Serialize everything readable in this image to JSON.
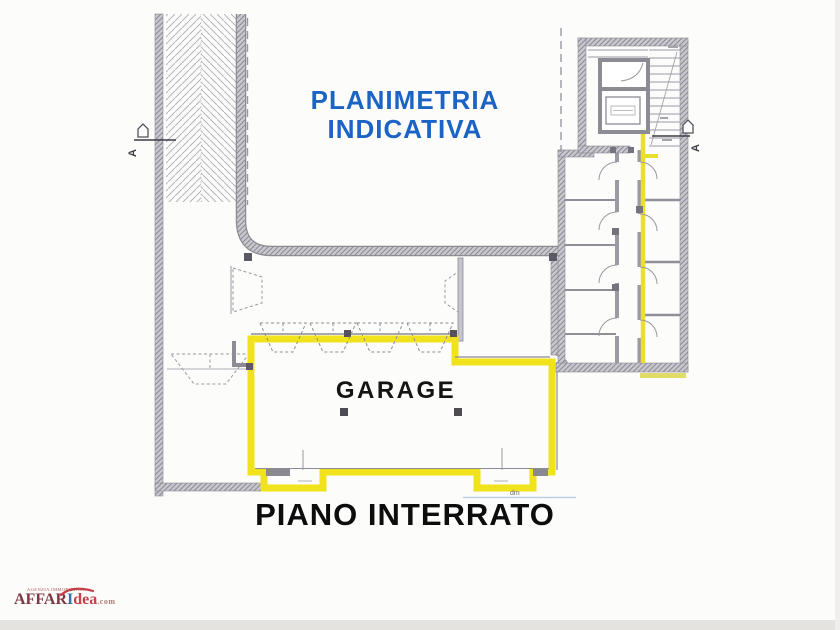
{
  "plan": {
    "title_line1": "PLANIMETRIA",
    "title_line2": "INDICATIVA",
    "garage_label": "GARAGE",
    "floor_label": "PIANO INTERRATO",
    "section_marker_left": "A",
    "section_marker_right": "A",
    "dim_mark": "dm"
  },
  "logo": {
    "tagline": "AGENZIA IMMOBILIARE",
    "name_main": "AFFAR",
    "name_i": "I",
    "name_idea": "dea",
    "name_domain": ".com"
  },
  "colors": {
    "highlight_yellow": "#f0e31c",
    "wall_gray": "#8f8d96",
    "title_blue": "#1b63c5",
    "text_black": "#141414",
    "logo_maroon": "#7e3744",
    "logo_red": "#c4424a",
    "logo_blue": "#3a6fae"
  }
}
